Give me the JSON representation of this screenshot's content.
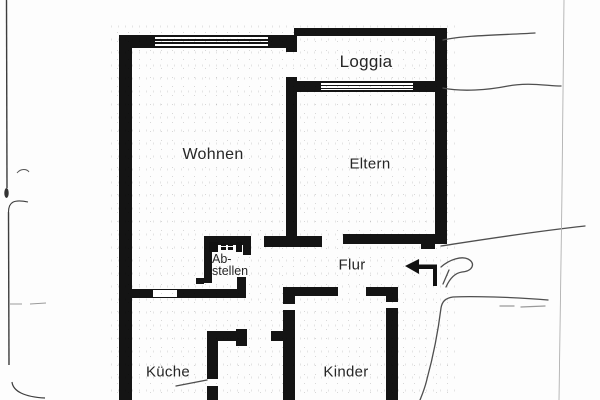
{
  "document": {
    "type": "scanned apartment floor plan",
    "paper_color": "#ffffff"
  },
  "colors": {
    "wall": "#141414",
    "label_text": "#262626",
    "pencil": "#4f4f4f",
    "faint_guide": "#b0b0b0"
  },
  "floor_plan": {
    "labels": {
      "loggia": "Loggia",
      "wohnen": "Wohnen",
      "eltern": "Eltern",
      "abstellen_line1": "Ab-",
      "abstellen_line2": "stellen",
      "flur": "Flur",
      "kueche": "Küche",
      "kinder": "Kinder"
    },
    "icons": {
      "entrance_arrow": "left-pointing entrance arrow",
      "abstellen_shelf": "shelf/appliance symbol",
      "windows": "double-line window symbols on north wall and loggia wall"
    },
    "annotations": {
      "pencil_marks": "hand-drawn pencil lines and scribble near entrance, scan margin lines left and right"
    }
  }
}
